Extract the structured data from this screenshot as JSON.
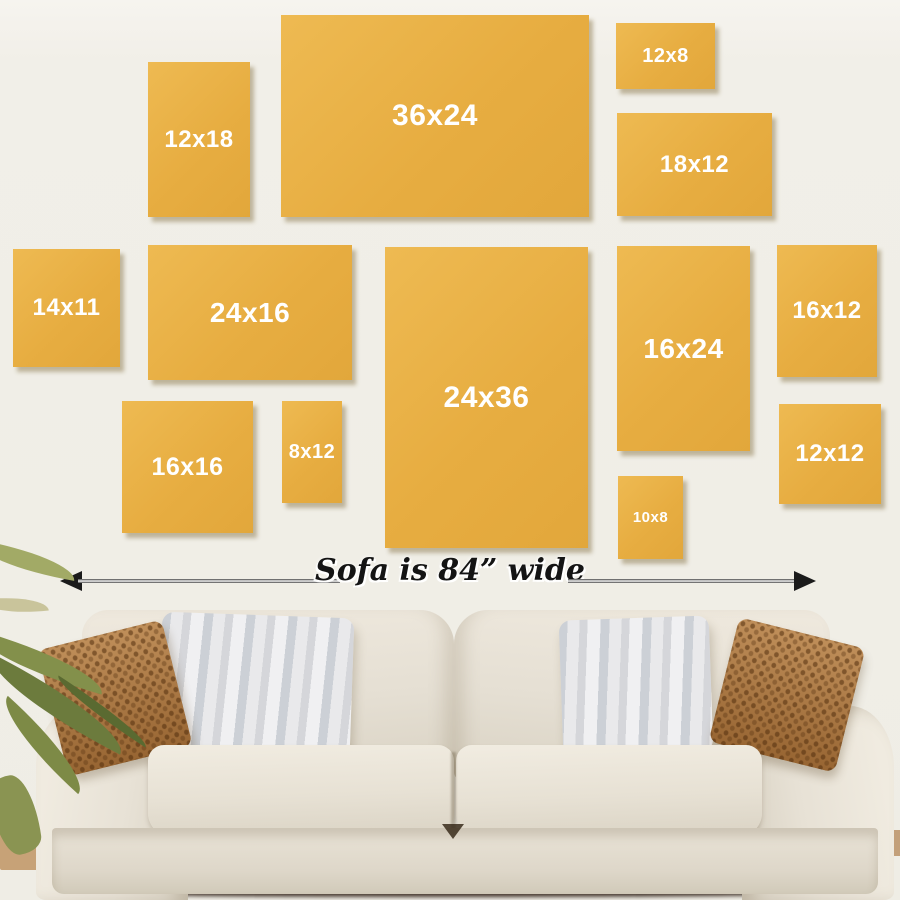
{
  "wall": {
    "color": "#f1efe9"
  },
  "size_guide": {
    "frame_color": "#e8b04a",
    "label_color": "#ffffff",
    "frames": [
      {
        "label": "12x18",
        "x": 148,
        "y": 62,
        "w": 102,
        "h": 155,
        "fs": 24
      },
      {
        "label": "36x24",
        "x": 281,
        "y": 15,
        "w": 308,
        "h": 202,
        "fs": 30
      },
      {
        "label": "12x8",
        "x": 616,
        "y": 23,
        "w": 99,
        "h": 66,
        "fs": 20
      },
      {
        "label": "18x12",
        "x": 617,
        "y": 113,
        "w": 155,
        "h": 103,
        "fs": 24
      },
      {
        "label": "14x11",
        "x": 13,
        "y": 249,
        "w": 107,
        "h": 118,
        "fs": 24
      },
      {
        "label": "24x16",
        "x": 148,
        "y": 245,
        "w": 204,
        "h": 135,
        "fs": 28
      },
      {
        "label": "24x36",
        "x": 385,
        "y": 247,
        "w": 203,
        "h": 301,
        "fs": 30
      },
      {
        "label": "16x24",
        "x": 617,
        "y": 246,
        "w": 133,
        "h": 205,
        "fs": 28
      },
      {
        "label": "16x12",
        "x": 777,
        "y": 245,
        "w": 100,
        "h": 132,
        "fs": 24
      },
      {
        "label": "16x16",
        "x": 122,
        "y": 401,
        "w": 131,
        "h": 132,
        "fs": 25
      },
      {
        "label": "8x12",
        "x": 282,
        "y": 401,
        "w": 60,
        "h": 102,
        "fs": 20
      },
      {
        "label": "12x12",
        "x": 779,
        "y": 404,
        "w": 102,
        "h": 100,
        "fs": 24
      },
      {
        "label": "10x8",
        "x": 618,
        "y": 476,
        "w": 65,
        "h": 83,
        "fs": 15
      }
    ]
  },
  "dimension": {
    "label": "Sofa is 84” wide",
    "arrow_color": "#1b1b1b"
  },
  "sofa": {
    "fabric_color": "#e5dfd3",
    "pillow_brown_color": "#b1793f",
    "pillow_gray_color": "#d6d7db"
  },
  "plant": {
    "leaf_color": "#7d8a46"
  },
  "floor_accent_color": "#c7a277"
}
